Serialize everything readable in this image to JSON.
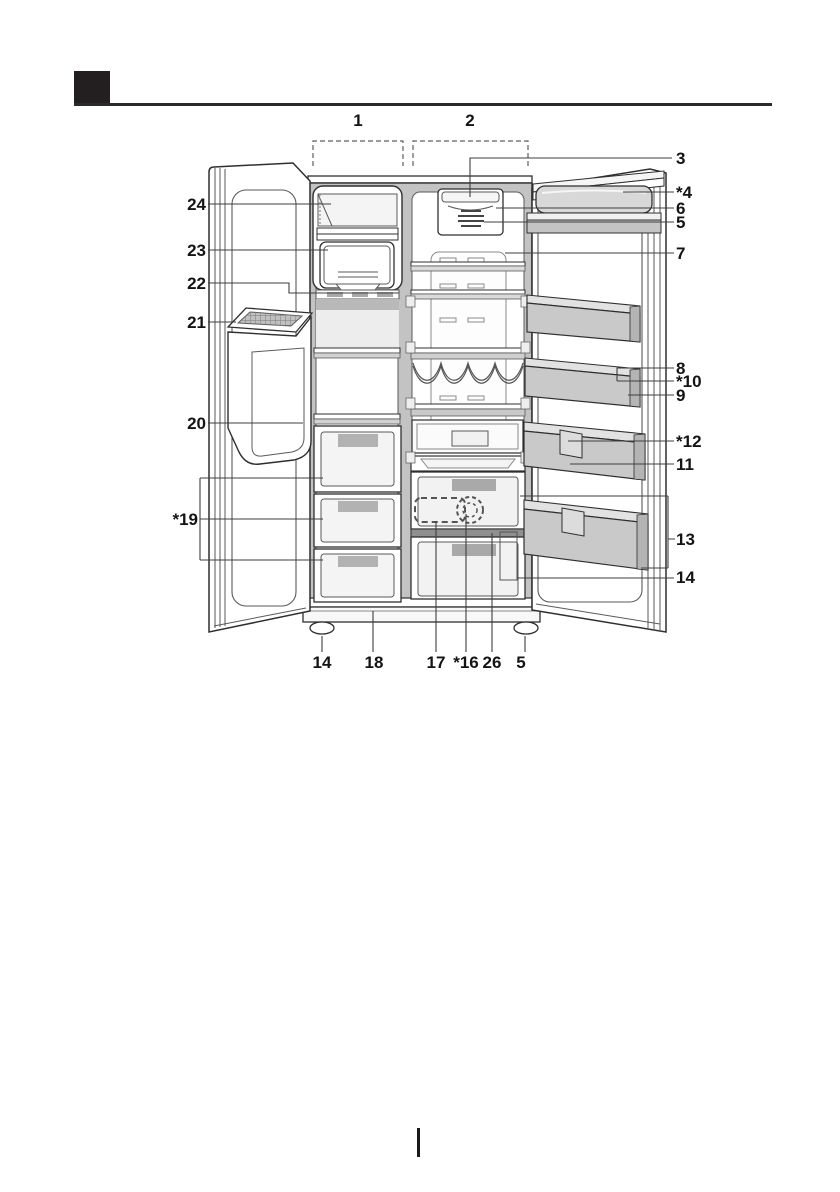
{
  "figure": {
    "regions": [
      {
        "label": "1"
      },
      {
        "label": "2"
      }
    ],
    "callouts_left": [
      {
        "label": "24"
      },
      {
        "label": "23"
      },
      {
        "label": "22"
      },
      {
        "label": "21"
      },
      {
        "label": "20"
      },
      {
        "label": "*19"
      }
    ],
    "callouts_right": [
      {
        "label": "3"
      },
      {
        "label": "*4"
      },
      {
        "label": "6"
      },
      {
        "label": "5"
      },
      {
        "label": "7"
      },
      {
        "label": "8"
      },
      {
        "label": "*10"
      },
      {
        "label": "9"
      },
      {
        "label": "*12"
      },
      {
        "label": "11"
      },
      {
        "label": "13"
      },
      {
        "label": "14"
      }
    ],
    "callouts_bottom": [
      {
        "label": "14"
      },
      {
        "label": "18"
      },
      {
        "label": "17"
      },
      {
        "label": "*16"
      },
      {
        "label": "26"
      },
      {
        "label": "5"
      }
    ]
  },
  "colors": {
    "outline": "#2f2f2f",
    "detail_line": "#5a5a5a",
    "leader_line": "#3f3f3f",
    "liner_gray": "#c3c3c3",
    "bin_gray": "#c9c9c9",
    "stripe_gray": "#a9a9a9",
    "divider_gray": "#8f8f8f",
    "marker_black": "#231f20",
    "background": "#ffffff"
  }
}
